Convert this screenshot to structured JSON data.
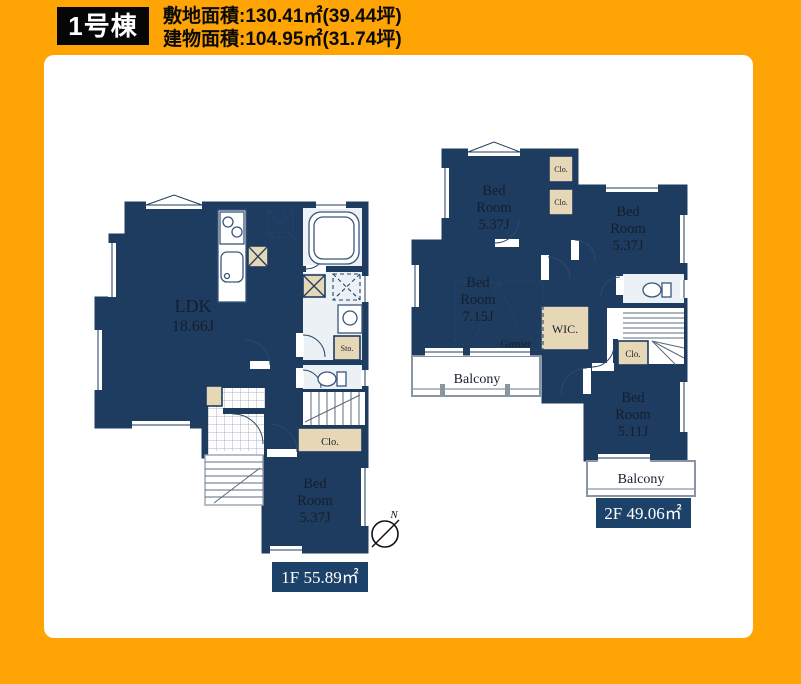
{
  "header": {
    "building_label": "1号棟",
    "site_area": "敷地面積:130.41㎡(39.44坪)",
    "building_area": "建物面積:104.95㎡(31.74坪)"
  },
  "floor1": {
    "ldk": [
      "LDK",
      "18.66J"
    ],
    "bedroom": [
      "Bed",
      "Room",
      "5.37J"
    ],
    "closet": "Clo.",
    "storage": "Sto.",
    "area_label": "1F 55.89㎡"
  },
  "floor2": {
    "bedroom_nw": [
      "Bed",
      "Room",
      "5.37J"
    ],
    "bedroom_ne": [
      "Bed",
      "Room",
      "5.37J"
    ],
    "bedroom_w": [
      "Bed",
      "Room",
      "7.15J"
    ],
    "bedroom_se": [
      "Bed",
      "Room",
      "5.11J"
    ],
    "wic": "WIC.",
    "grenier": "Grenier",
    "closet_a": "Clo.",
    "closet_b": "Clo.",
    "closet_c": "Clo.",
    "balcony_west": "Balcony",
    "balcony_south": "Balcony",
    "area_label": "2F 49.06㎡"
  },
  "compass": {
    "north": "N"
  },
  "colors": {
    "frame": "#FFA405",
    "wall": "#1E3C60",
    "closet_tan": "#E6D8B7",
    "area_label_bg": "#1D4269",
    "header_tag_bg": "#060606"
  }
}
